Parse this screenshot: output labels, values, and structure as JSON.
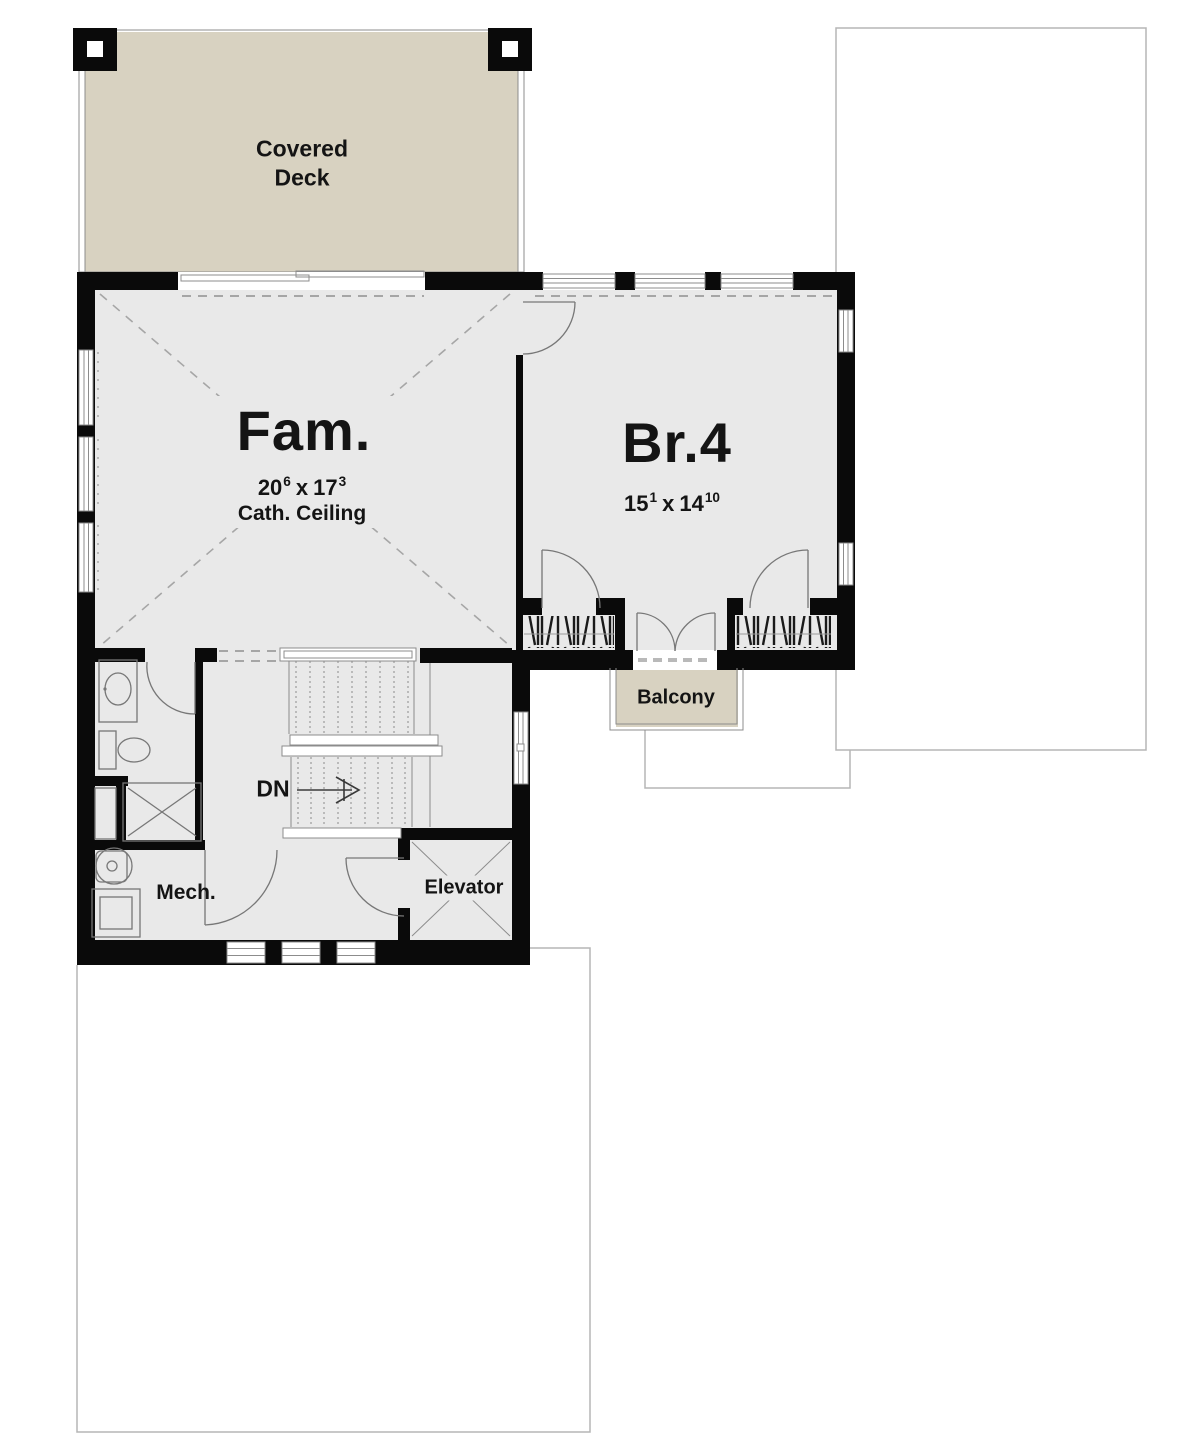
{
  "plan": {
    "rooms": {
      "covered_deck": {
        "label_line1": "Covered",
        "label_line2": "Deck"
      },
      "family": {
        "name": "Fam.",
        "w": "20",
        "w_sup": "6",
        "sep": "x",
        "h": "17",
        "h_sup": "3",
        "ceiling": "Cath. Ceiling"
      },
      "bedroom4": {
        "name": "Br.4",
        "w": "15",
        "w_sup": "1",
        "sep": "x",
        "h": "14",
        "h_sup": "10"
      },
      "balcony": {
        "label": "Balcony"
      },
      "mechanical": {
        "label": "Mech."
      },
      "elevator": {
        "label": "Elevator"
      },
      "stairs": {
        "label": "DN"
      }
    },
    "colors": {
      "deck_fill": "#d8d2c1",
      "room_fill": "#e9e9e9",
      "wall": "#0a0a0a",
      "line": "#8c8c8c",
      "dash": "#a6a6a6",
      "outline": "#b5b5b5",
      "ink": "#141414",
      "background": "#ffffff"
    }
  }
}
